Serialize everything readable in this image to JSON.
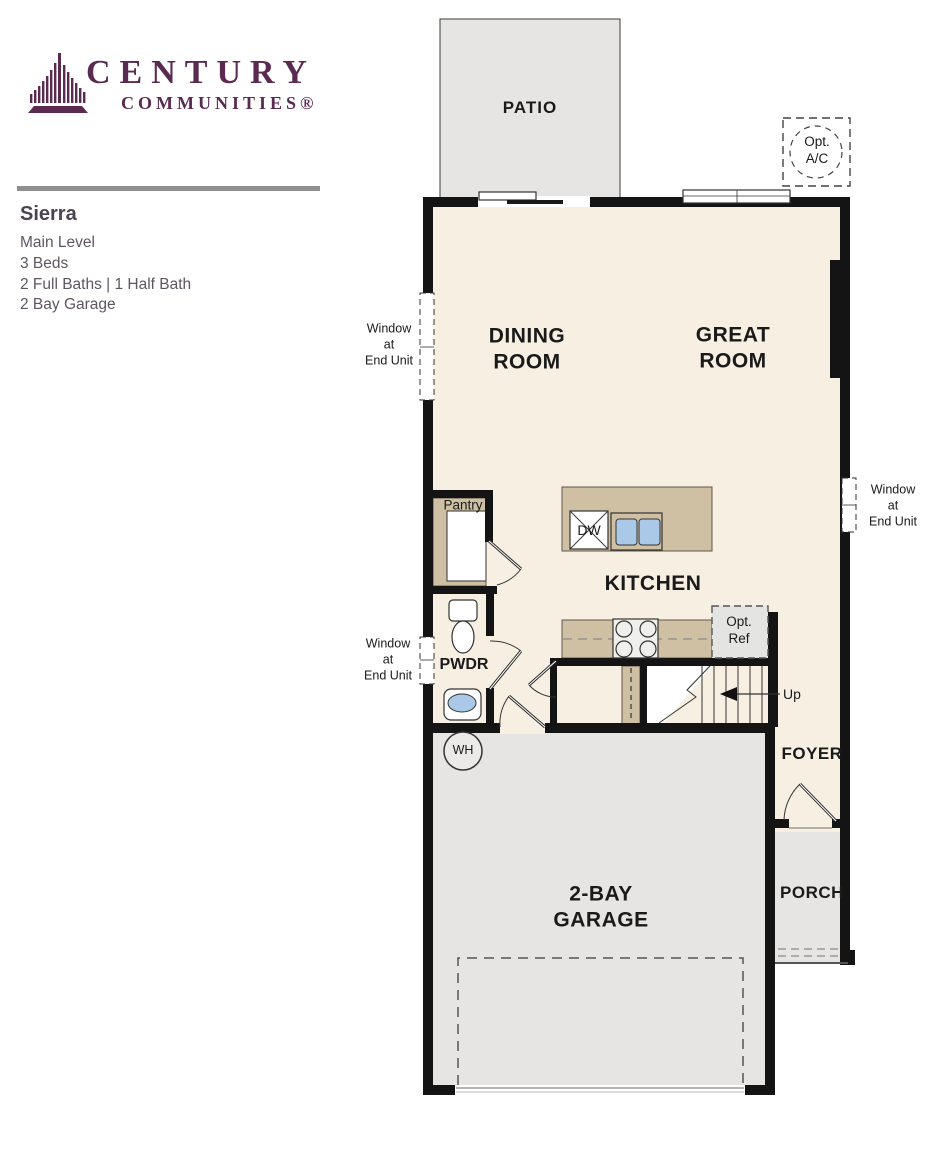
{
  "brand": {
    "logo_title": "CENTURY",
    "logo_subtitle": "COMMUNITIES®",
    "brand_color": "#5b2a51"
  },
  "plan": {
    "name": "Sierra",
    "level": "Main Level",
    "beds": "3 Beds",
    "baths": "2 Full Baths | 1 Half Bath",
    "garage": "2 Bay Garage"
  },
  "floorplan": {
    "labels": {
      "patio": "PATIO",
      "dining": [
        "DINING",
        "ROOM"
      ],
      "great": [
        "GREAT",
        "ROOM"
      ],
      "kitchen": "KITCHEN",
      "pantry": "Pantry",
      "pwdr": "PWDR",
      "foyer": "FOYER",
      "porch": "PORCH",
      "garage": [
        "2-BAY",
        "GARAGE"
      ],
      "dw": "DW",
      "wh": "WH",
      "up": "Up",
      "opt_ac": [
        "Opt.",
        "A/C"
      ],
      "opt_ref": [
        "Opt.",
        "Ref"
      ],
      "window_note": [
        "Window",
        "at",
        "End Unit"
      ]
    },
    "colors": {
      "floor": "#f8efe3",
      "outdoor": "#e6e5e3",
      "cabinet": "#cfc0a4",
      "sink_blue": "#aac9e8",
      "wall": "#141414"
    }
  }
}
